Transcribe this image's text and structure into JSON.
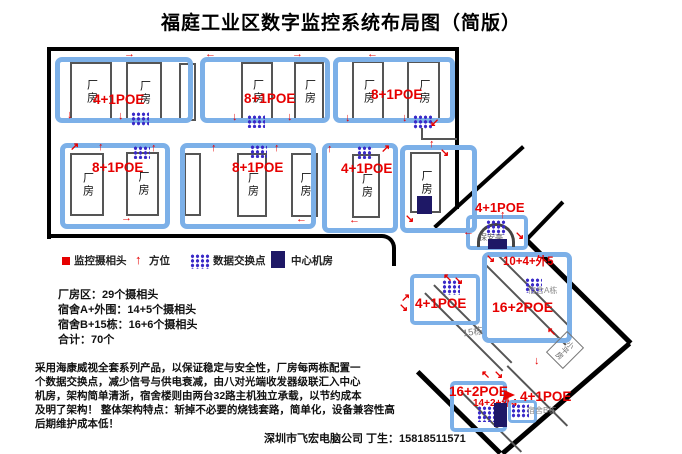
{
  "title": "福庭工业区数字监控系统布局图（简版）",
  "icons": {
    "up": "↑",
    "down": "↓",
    "left": "←",
    "right": "→",
    "up_left": "↖",
    "up_right": "↗",
    "down_left": "↙",
    "down_right": "↘"
  },
  "labels": {
    "factory": "厂房",
    "guard": "保安亭",
    "dorm_a": "宿舍A栋",
    "dorm_b": "宿舍B栋",
    "bldg15": "15栋",
    "small_house": "小平房"
  },
  "poe": {
    "r1a": "4+1POE",
    "r1b": "8+1POE",
    "r1c": "8+1POE",
    "r2a": "8+1POE",
    "r2b": "8+1POE",
    "r2c": "4+1POE",
    "gate": "4+1POE",
    "dorm_a_top": "10+4+外5",
    "dorm_a_main": "16+2POE",
    "west": "4+1POE",
    "dorm_b_main": "16+2POE",
    "dorm_b_sub": "14+2+外4",
    "dorm_b_right": "4+1POE"
  },
  "legend": {
    "camera": "监控摄相头",
    "direction": "方位",
    "switch": "数据交换点",
    "center_room": "中心机房"
  },
  "stats": [
    "厂房区：29个摄相头",
    "宿舍A+外围：14+5个摄相头",
    "宿舍B+15栋：16+6个摄相头",
    "合计：70个"
  ],
  "description": [
    "采用海康威视全套系列产品，以保证稳定与安全性，厂房每两栋配置一",
    "个数据交换点，减少信号与供电衰减，由八对光端收发器级联汇入中心",
    "机房，架构简单清浙，宿舍楼则由两台32路主机独立承载，以节约成本",
    "及明了架构！ 整体架构特点：斩掉不必要的烧钱套路，简单化，设备兼容性高",
    "后期维护成本低！"
  ],
  "footer": "深圳市飞宏电脑公司 丁生：15818511571",
  "colors": {
    "group_box": "#7cb0e8",
    "camera_red": "#e60000",
    "switch_purple": "#3a2ac8",
    "center_navy": "#1e1866"
  }
}
